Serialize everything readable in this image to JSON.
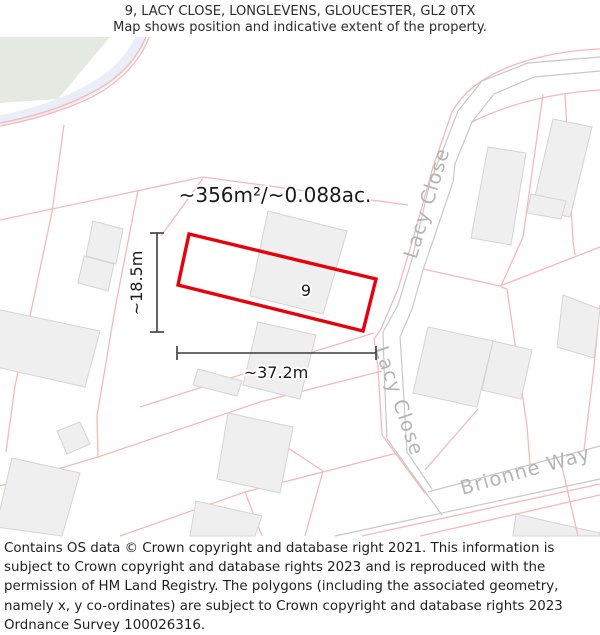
{
  "header": {
    "line1": "9, LACY CLOSE, LONGLEVENS, GLOUCESTER, GL2 0TX",
    "line2": "Map shows position and indicative extent of the property."
  },
  "map": {
    "area_label": "~356m²/~0.088ac.",
    "plot_number": "9",
    "width_label": "~37.2m",
    "height_label": "~18.5m",
    "streets": {
      "lacy_close_upper": "Lacy Close",
      "lacy_close_lower": "Lacy Close",
      "brionne_way": "Brionne Way"
    },
    "colors": {
      "plot_outline": "#e8000b",
      "parcel_line": "#f5b9b9",
      "road_edge": "#c8c8c8",
      "building_fill": "#efefef",
      "building_stroke": "#d4d4d4",
      "street_text": "#b5b5b5",
      "green_area": "#e4eae2",
      "water": "#e9eef8",
      "dimension": "#3c3c3c"
    }
  },
  "footer": {
    "text": "Contains OS data © Crown copyright and database right 2021. This information is subject to Crown copyright and database rights 2023 and is reproduced with the permission of HM Land Registry. The polygons (including the associated geometry, namely x, y co-ordinates) are subject to Crown copyright and database rights 2023 Ordnance Survey 100026316."
  }
}
